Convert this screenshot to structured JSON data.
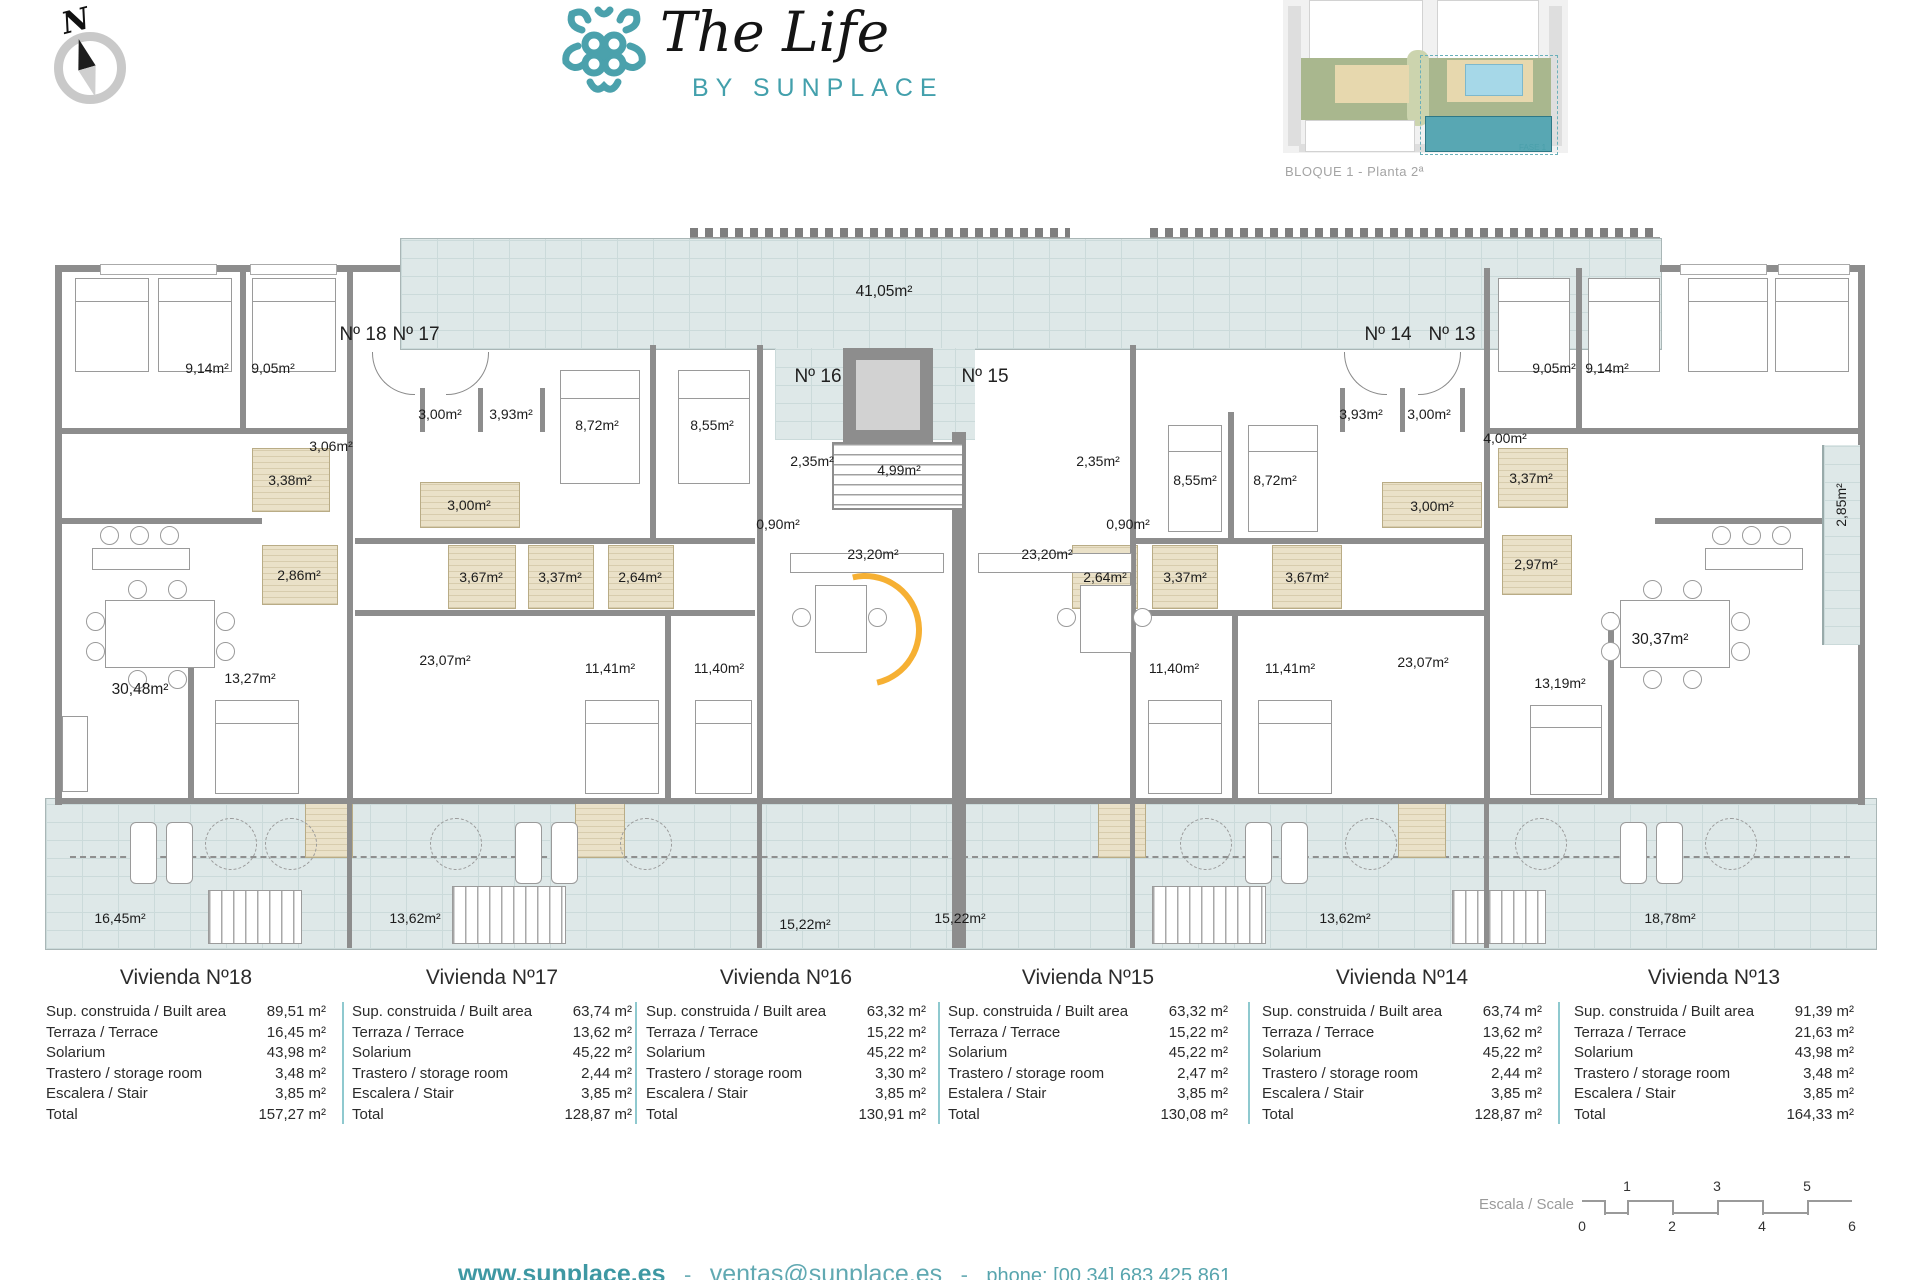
{
  "brand": {
    "teal": "#4aa0ab"
  },
  "header": {
    "compass_n": "N",
    "logo_title": "The Life",
    "logo_subtitle": "BY SUNPLACE",
    "siteplan_caption": "BLOQUE 1 - Planta 2ª",
    "siteplan_fase": "FASE 1"
  },
  "plan": {
    "labels": [
      {
        "t": "Nº 18",
        "x": 363,
        "y": 335,
        "cls": "unit"
      },
      {
        "t": "Nº 17",
        "x": 416,
        "y": 335,
        "cls": "unit"
      },
      {
        "t": "Nº 16",
        "x": 818,
        "y": 377,
        "cls": "unit"
      },
      {
        "t": "Nº 15",
        "x": 985,
        "y": 377,
        "cls": "unit"
      },
      {
        "t": "Nº 14",
        "x": 1388,
        "y": 335,
        "cls": "unit"
      },
      {
        "t": "Nº 13",
        "x": 1452,
        "y": 335,
        "cls": "unit"
      },
      {
        "t": "41,05m²",
        "x": 884,
        "y": 292,
        "cls": "big"
      },
      {
        "t": "9,14m²",
        "x": 207,
        "y": 368
      },
      {
        "t": "9,05m²",
        "x": 273,
        "y": 368
      },
      {
        "t": "3,06m²",
        "x": 331,
        "y": 446
      },
      {
        "t": "3,00m²",
        "x": 440,
        "y": 414
      },
      {
        "t": "3,93m²",
        "x": 511,
        "y": 414
      },
      {
        "t": "8,72m²",
        "x": 597,
        "y": 425
      },
      {
        "t": "8,55m²",
        "x": 712,
        "y": 425
      },
      {
        "t": "3,38m²",
        "x": 290,
        "y": 480
      },
      {
        "t": "3,00m²",
        "x": 469,
        "y": 505
      },
      {
        "t": "2,35m²",
        "x": 812,
        "y": 461
      },
      {
        "t": "0,90m²",
        "x": 778,
        "y": 524
      },
      {
        "t": "4,99m²",
        "x": 899,
        "y": 470
      },
      {
        "t": "23,20m²",
        "x": 873,
        "y": 554
      },
      {
        "t": "23,20m²",
        "x": 1047,
        "y": 554
      },
      {
        "t": "2,35m²",
        "x": 1098,
        "y": 461
      },
      {
        "t": "0,90m²",
        "x": 1128,
        "y": 524
      },
      {
        "t": "8,55m²",
        "x": 1195,
        "y": 480
      },
      {
        "t": "8,72m²",
        "x": 1275,
        "y": 480
      },
      {
        "t": "3,93m²",
        "x": 1361,
        "y": 414
      },
      {
        "t": "3,00m²",
        "x": 1429,
        "y": 414
      },
      {
        "t": "9,05m²",
        "x": 1554,
        "y": 368
      },
      {
        "t": "9,14m²",
        "x": 1607,
        "y": 368
      },
      {
        "t": "4,00m²",
        "x": 1505,
        "y": 438
      },
      {
        "t": "3,00m²",
        "x": 1432,
        "y": 506
      },
      {
        "t": "3,37m²",
        "x": 1531,
        "y": 478
      },
      {
        "t": "2,86m²",
        "x": 299,
        "y": 575
      },
      {
        "t": "3,67m²",
        "x": 481,
        "y": 577
      },
      {
        "t": "3,37m²",
        "x": 560,
        "y": 577
      },
      {
        "t": "2,64m²",
        "x": 640,
        "y": 577
      },
      {
        "t": "2,64m²",
        "x": 1105,
        "y": 577
      },
      {
        "t": "3,37m²",
        "x": 1185,
        "y": 577
      },
      {
        "t": "3,67m²",
        "x": 1307,
        "y": 577
      },
      {
        "t": "2,97m²",
        "x": 1536,
        "y": 564
      },
      {
        "t": "30,48m²",
        "x": 140,
        "y": 690,
        "cls": "big"
      },
      {
        "t": "13,27m²",
        "x": 250,
        "y": 678
      },
      {
        "t": "23,07m²",
        "x": 445,
        "y": 660
      },
      {
        "t": "11,41m²",
        "x": 610,
        "y": 668
      },
      {
        "t": "11,40m²",
        "x": 719,
        "y": 668
      },
      {
        "t": "11,40m²",
        "x": 1174,
        "y": 668
      },
      {
        "t": "11,41m²",
        "x": 1290,
        "y": 668
      },
      {
        "t": "23,07m²",
        "x": 1423,
        "y": 662
      },
      {
        "t": "13,19m²",
        "x": 1560,
        "y": 683
      },
      {
        "t": "30,37m²",
        "x": 1660,
        "y": 640,
        "cls": "big"
      },
      {
        "t": "2,85m²",
        "x": 1841,
        "y": 505,
        "cls": "rot"
      },
      {
        "t": "16,45m²",
        "x": 120,
        "y": 918
      },
      {
        "t": "13,62m²",
        "x": 415,
        "y": 918
      },
      {
        "t": "15,22m²",
        "x": 805,
        "y": 924
      },
      {
        "t": "15,22m²",
        "x": 960,
        "y": 918
      },
      {
        "t": "13,62m²",
        "x": 1345,
        "y": 918
      },
      {
        "t": "18,78m²",
        "x": 1670,
        "y": 918
      }
    ]
  },
  "tables": [
    {
      "title": "Vivienda Nº18",
      "rows": [
        {
          "l": "Sup. construida / Built area",
          "v": "89,51 m²"
        },
        {
          "l": "Terraza / Terrace",
          "v": "16,45 m²"
        },
        {
          "l": "Solarium",
          "v": "43,98 m²"
        },
        {
          "l": "Trastero / storage room",
          "v": "3,48 m²"
        },
        {
          "l": "Escalera / Stair",
          "v": "3,85 m²"
        },
        {
          "l": "Total",
          "v": "157,27 m²"
        }
      ]
    },
    {
      "title": "Vivienda Nº17",
      "rows": [
        {
          "l": "Sup. construida / Built area",
          "v": "63,74 m²"
        },
        {
          "l": "Terraza / Terrace",
          "v": "13,62 m²"
        },
        {
          "l": "Solarium",
          "v": "45,22 m²"
        },
        {
          "l": "Trastero / storage room",
          "v": "2,44 m²"
        },
        {
          "l": "Escalera / Stair",
          "v": "3,85 m²"
        },
        {
          "l": "Total",
          "v": "128,87 m²"
        }
      ]
    },
    {
      "title": "Vivienda Nº16",
      "rows": [
        {
          "l": "Sup. construida / Built area",
          "v": "63,32 m²"
        },
        {
          "l": "Terraza / Terrace",
          "v": "15,22 m²"
        },
        {
          "l": "Solarium",
          "v": "45,22 m²"
        },
        {
          "l": "Trastero / storage room",
          "v": "3,30 m²"
        },
        {
          "l": "Escalera / Stair",
          "v": "3,85 m²"
        },
        {
          "l": "Total",
          "v": "130,91 m²"
        }
      ]
    },
    {
      "title": "Vivienda Nº15",
      "rows": [
        {
          "l": "Sup. construida / Built area",
          "v": "63,32 m²"
        },
        {
          "l": "Terraza / Terrace",
          "v": "15,22 m²"
        },
        {
          "l": "Solarium",
          "v": "45,22 m²"
        },
        {
          "l": "Trastero / storage room",
          "v": "2,47 m²"
        },
        {
          "l": "Estalera / Stair",
          "v": "3,85 m²"
        },
        {
          "l": "Total",
          "v": "130,08 m²"
        }
      ]
    },
    {
      "title": "Vivienda Nº14",
      "rows": [
        {
          "l": "Sup. construida / Built area",
          "v": "63,74 m²"
        },
        {
          "l": "Terraza / Terrace",
          "v": "13,62 m²"
        },
        {
          "l": "Solarium",
          "v": "45,22 m²"
        },
        {
          "l": "Trastero / storage room",
          "v": "2,44 m²"
        },
        {
          "l": "Escalera / Stair",
          "v": "3,85 m²"
        },
        {
          "l": "Total",
          "v": "128,87 m²"
        }
      ]
    },
    {
      "title": "Vivienda Nº13",
      "rows": [
        {
          "l": "Sup. construida / Built area",
          "v": "91,39 m²"
        },
        {
          "l": "Terraza / Terrace",
          "v": "21,63 m²"
        },
        {
          "l": "Solarium",
          "v": "43,98 m²"
        },
        {
          "l": "Trastero / storage room",
          "v": "3,48 m²"
        },
        {
          "l": "Escalera / Stair",
          "v": "3,85 m²"
        },
        {
          "l": "Total",
          "v": "164,33 m²"
        }
      ]
    }
  ],
  "scale": {
    "caption": "Escala / Scale",
    "top": [
      {
        "t": "1",
        "x": 1627
      },
      {
        "t": "3",
        "x": 1717
      },
      {
        "t": "5",
        "x": 1807
      }
    ],
    "bottom": [
      {
        "t": "0",
        "x": 1582
      },
      {
        "t": "2",
        "x": 1672
      },
      {
        "t": "4",
        "x": 1762
      },
      {
        "t": "6",
        "x": 1852
      }
    ]
  },
  "footer": {
    "website": "www.sunplace.es",
    "separator": "-",
    "email": "ventas@sunplace.es",
    "phone_label": "phone: [00 34] 683 425 861"
  }
}
